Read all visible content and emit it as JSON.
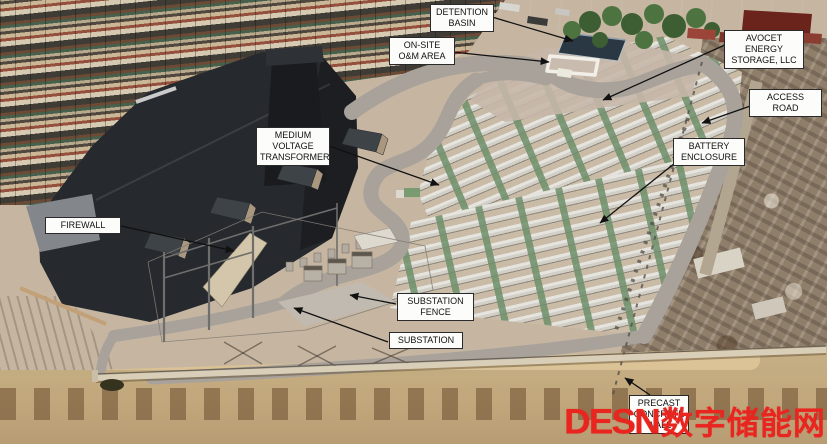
{
  "labels": {
    "detention_basin": "DETENTION\nBASIN",
    "onsite_om_area": "ON-SITE\nO&M AREA",
    "avocet_energy_storage": "AVOCET ENERGY\nSTORAGE, LLC",
    "access_road": "ACCESS ROAD",
    "medium_voltage_transformer": "MEDIUM\nVOLTAGE\nTRANSFORMER",
    "battery_enclosure": "BATTERY\nENCLOSURE",
    "firewall": "FIREWALL",
    "substation_fence": "SUBSTATION\nFENCE",
    "substation": "SUBSTATION",
    "precast_concrete_wall": "PRECAST\nCONCRETE\nWALL"
  },
  "watermark": {
    "latin": "DESN",
    "cjk": "数字储能网",
    "color": "#e8251f"
  },
  "colors": {
    "gravel_yard": "#c6b6a1",
    "road": "#a8a29a",
    "battery_unit": "#d8d5ce",
    "battery_green_unit": "#6d8f6a",
    "warehouse_roof": "#26292d",
    "detention_basin_water": "#2a3844",
    "dirt_strip": "#c2a87c",
    "precast_wall": "#d9cfb8",
    "label_background": "#fcfcfa",
    "label_border": "#2a2a2a"
  }
}
